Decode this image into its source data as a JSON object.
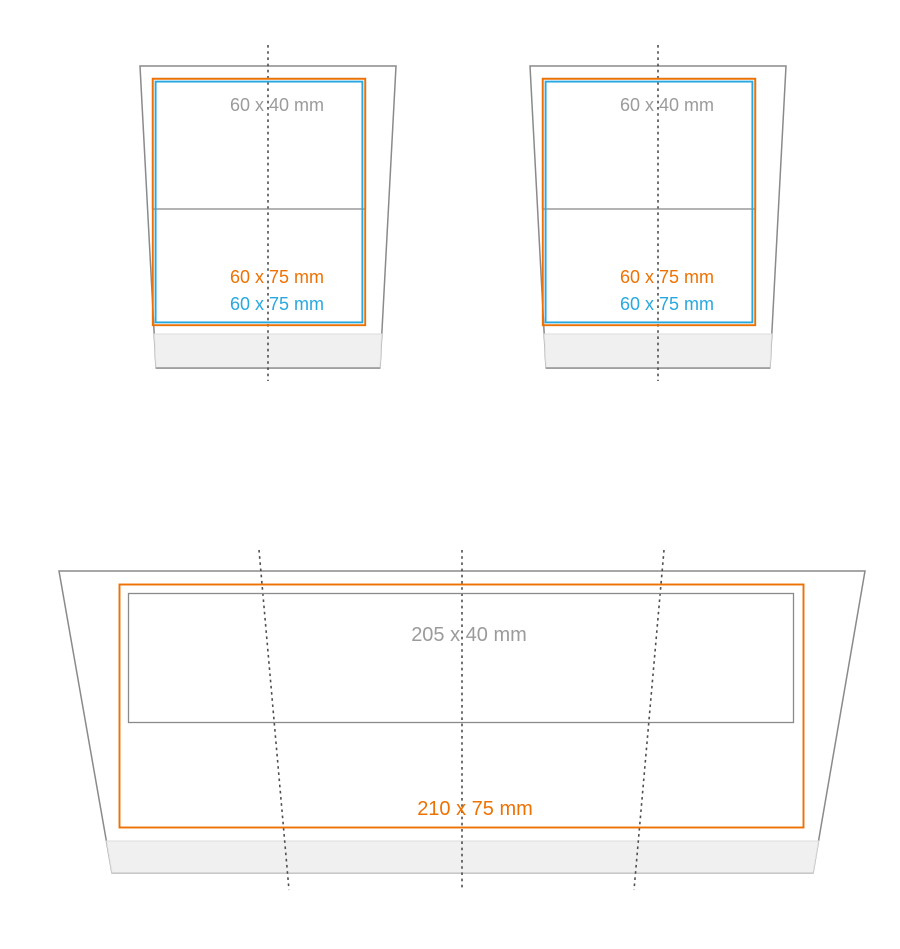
{
  "colors": {
    "orange": "#EE7203",
    "blue": "#29A8E0",
    "outline_gray": "#8A8A8A",
    "text_gray": "#9B9B9B",
    "fold_line": "#4E4E4E",
    "base_fill": "#F0F0F0",
    "base_edge": "#DCDCDC",
    "base_bottom_small": "#949494",
    "base_bottom_large": "#C9C9C9"
  },
  "small_cups": [
    {
      "name": "small-cup-left",
      "top_area_label": "60 x 40 mm",
      "print_area_orange_label": "60 x 75 mm",
      "print_area_blue_label": "60 x 75 mm"
    },
    {
      "name": "small-cup-right",
      "top_area_label": "60 x 40 mm",
      "print_area_orange_label": "60 x 75 mm",
      "print_area_blue_label": "60 x 75 mm"
    }
  ],
  "large_cup": {
    "name": "large-cup-wrap",
    "top_area_label": "205 x 40 mm",
    "print_area_label": "210 x 75 mm"
  }
}
